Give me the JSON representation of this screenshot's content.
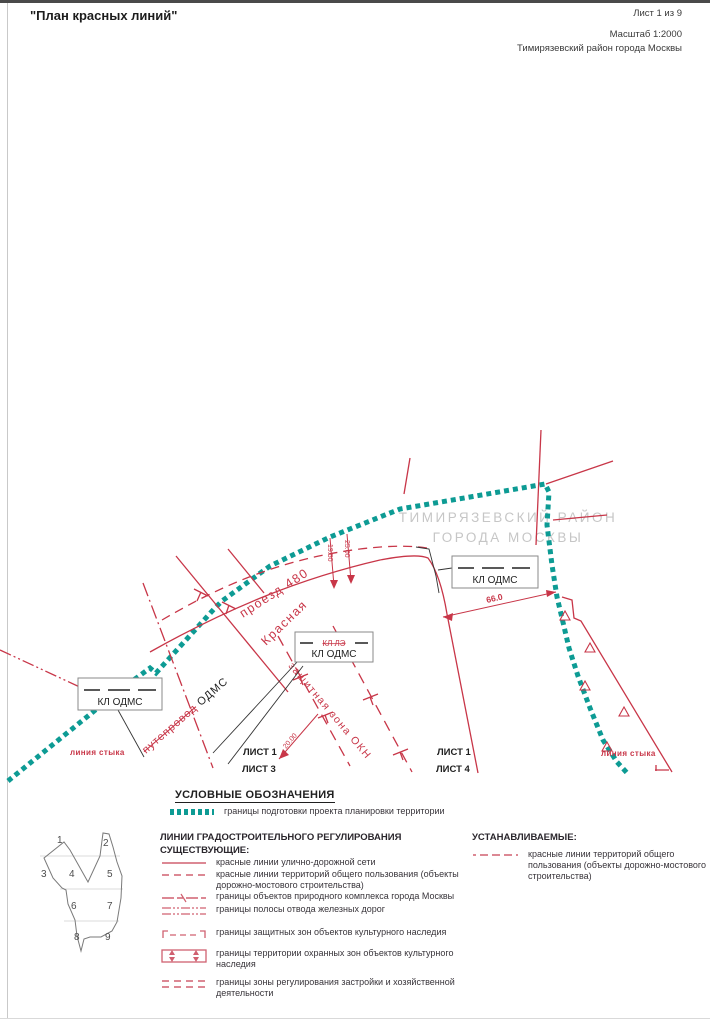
{
  "header": {
    "title": "\"План красных линий\"",
    "sheet_info": "Лист 1 из 9",
    "scale": "Масштаб 1:2000",
    "district": "Тимирязевский район города Москвы"
  },
  "map": {
    "region_line1": "ТИМИРЯЗЕВСКИЙ РАЙОН",
    "region_line2": "ГОРОДА МОСКВЫ",
    "callout_label": "КЛ ОДМС",
    "callout_struck": "КЛ ЛЭ",
    "road_label": "проезд 480",
    "street_label": "Красная",
    "zone_label": "защитная зона ОКН",
    "overpass_struck": "путепровод",
    "overpass_new": "ОДМС",
    "seam_label": "линия стыка",
    "dim_a": "19.50",
    "dim_b": "25.00",
    "dim_c": "66.0",
    "dim_d": "20.00",
    "sheet_left_top": "ЛИСТ 1",
    "sheet_left_bottom": "ЛИСТ 3",
    "sheet_right_top": "ЛИСТ 1",
    "sheet_right_bottom": "ЛИСТ 4"
  },
  "legend": {
    "title": "УСЛОВНЫЕ ОБОЗНАЧЕНИЯ",
    "boundary_item": "границы подготовки проекта планировки территории",
    "section_title": "ЛИНИИ ГРАДОСТРОИТЕЛЬНОГО РЕГУЛИРОВАНИЯ",
    "existing_title": "СУЩЕСТВУЮЩИЕ:",
    "established_title": "УСТАНАВЛИВАЕМЫЕ:",
    "existing_items": [
      "красные линии улично-дорожной сети",
      "красные линии территорий общего пользования (объекты дорожно-мостового строительства)",
      "границы объектов природного комплекса города Москвы",
      "границы полосы отвода железных дорог",
      "границы защитных зон объектов культурного наследия",
      "границы территории охранных зон объектов культурного наследия",
      "границы зоны регулирования застройки и хозяйственной деятельности"
    ],
    "established_items": [
      "красные линии территорий общего пользования (объекты дорожно-мостового строительства)"
    ]
  },
  "sheet_index": {
    "numbers": [
      "1",
      "2",
      "3",
      "4",
      "5",
      "6",
      "7",
      "8",
      "9"
    ]
  },
  "colors": {
    "red": "#c83648",
    "red_soft": "#d06070",
    "teal": "#0d9b94",
    "gray_label": "#c6c6c6"
  }
}
